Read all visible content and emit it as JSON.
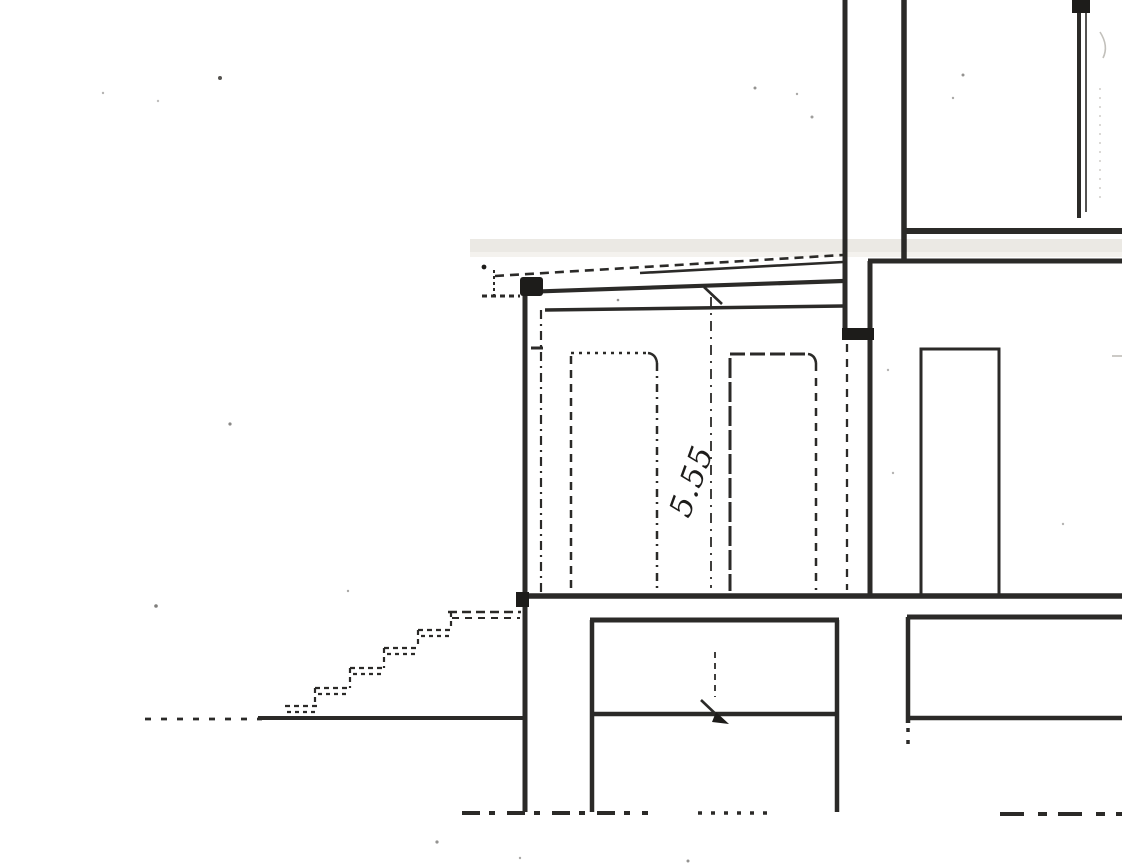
{
  "drawing": {
    "dimension_label": "5.55",
    "colors": {
      "ink": "#1d1c1a",
      "paper": "#ffffff",
      "scan_band": "#ebe9e4",
      "scan_band_light": "#f4f2ee",
      "faint": "#9a968e"
    }
  }
}
